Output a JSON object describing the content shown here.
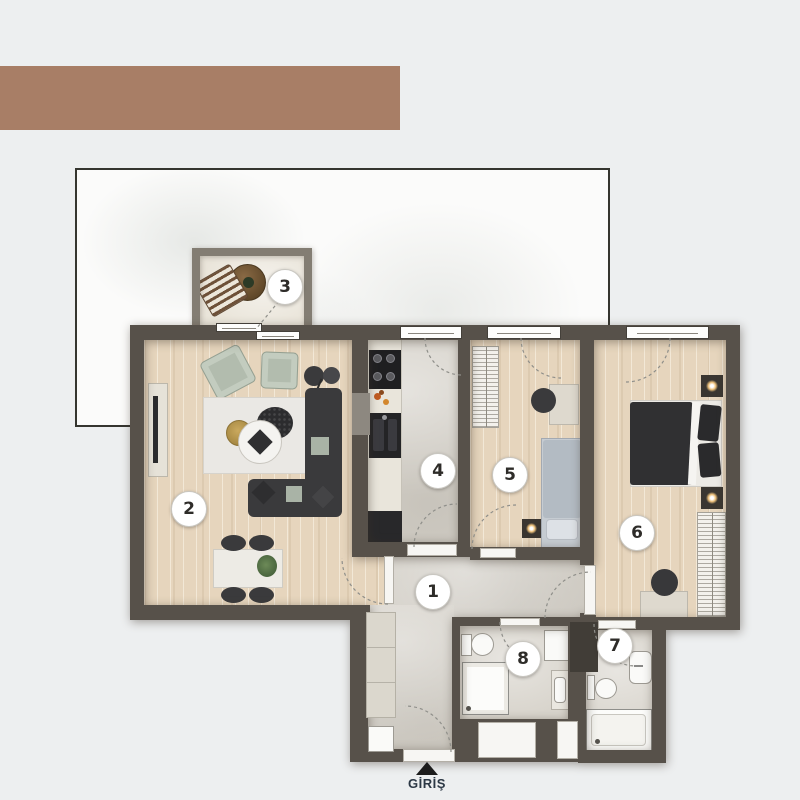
{
  "page": {
    "background_color": "#edeff0"
  },
  "brand_bar": {
    "color": "#a87e66"
  },
  "backdrop": {
    "style": "white-marble-panel",
    "border_color": "#35352f"
  },
  "floor_plan": {
    "rooms": [
      {
        "number": "1"
      },
      {
        "number": "2"
      },
      {
        "number": "3"
      },
      {
        "number": "4"
      },
      {
        "number": "5"
      },
      {
        "number": "6"
      },
      {
        "number": "7"
      },
      {
        "number": "8"
      }
    ],
    "entrance": {
      "label": "GİRİŞ",
      "arrow_icon": "triangle-up",
      "text_color": "#2c3845"
    }
  },
  "palette": {
    "wall": "#57514a",
    "balcony_wall": "#837d73",
    "wood_floor": "#e6d5bd",
    "stone_floor": "#d5d1c9",
    "bath_floor": "#d8d4cc",
    "sofa_dark": "#3a3a3c",
    "sage_chair": "#b2bcae",
    "gold_accent": "#b5964e",
    "bed_gray": "#b3bbc3",
    "label_text": "#2e2c29"
  }
}
